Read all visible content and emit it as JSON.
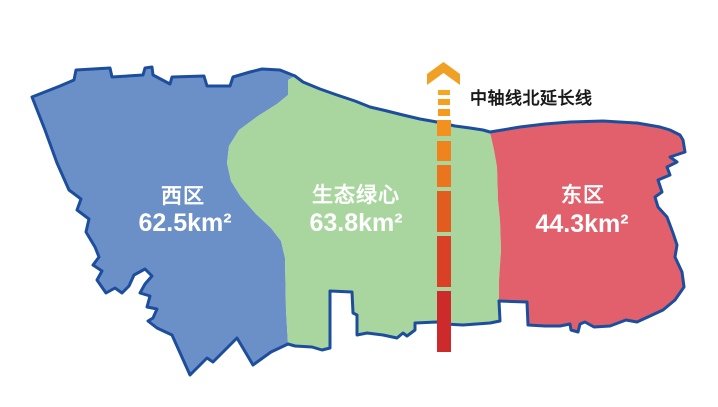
{
  "figure": {
    "background": "#FFFFFF",
    "outline_color": "#1D4E9E",
    "label_text_color": "#FFFFFF",
    "regions": [
      {
        "id": "west-district",
        "name": "西区",
        "area": "62.5km²",
        "fill_color": "#6B90C7"
      },
      {
        "id": "green-heart",
        "name": "生态绿心",
        "area": "63.8km²",
        "fill_color": "#A9D69E"
      },
      {
        "id": "east-district",
        "name": "东区",
        "area": "44.3km²",
        "fill_color": "#E2606B"
      }
    ],
    "axis_line": {
      "label": "中轴线北延长线",
      "label_color": "#1A1A1A",
      "color_top": "#F6A71F",
      "color_bottom": "#CC2A2B",
      "style": "dashed-vertical-with-up-arrow"
    }
  }
}
